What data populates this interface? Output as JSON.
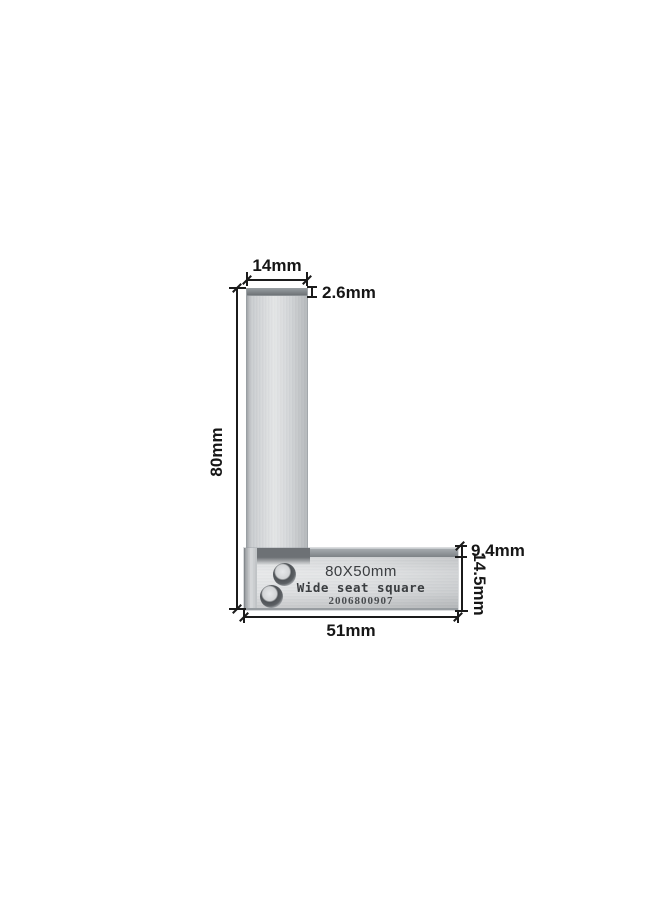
{
  "product": {
    "engraving_size": "80X50mm",
    "engraving_name": "Wide seat square",
    "engraving_serial": "2006800907"
  },
  "dimensions": {
    "blade_width": "14mm",
    "blade_thickness": "2.6mm",
    "blade_length": "80mm",
    "seat_step": "9.4mm",
    "seat_height": "14.5mm",
    "seat_length": "51mm"
  },
  "colors": {
    "background": "#ffffff",
    "dimension_ink": "#1b1b1b",
    "metal_light": "#dddfe1",
    "metal_mid": "#c5c8cb",
    "metal_dark_edge": "#6e7377",
    "engraving_ink": "#3a3d40"
  }
}
